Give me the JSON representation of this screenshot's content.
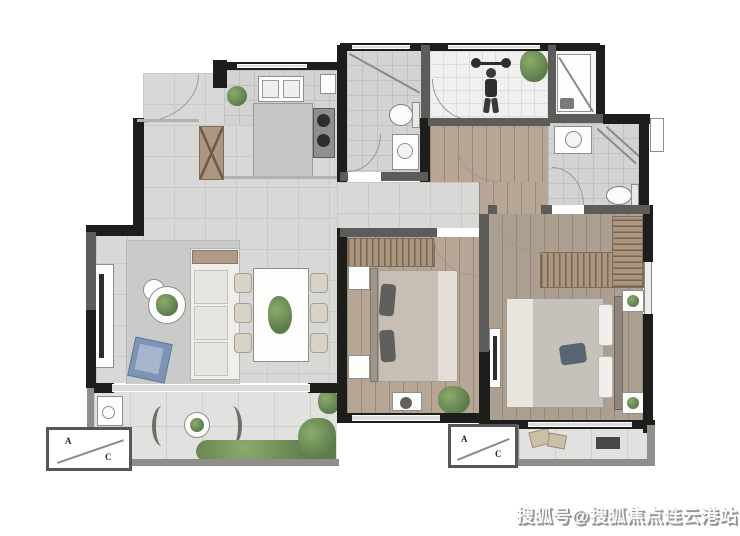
{
  "watermark": {
    "text": "搜狐号@搜狐焦点连云港站"
  },
  "ac_platforms": {
    "label_a": "A",
    "label_c": "C"
  },
  "colors": {
    "wall": "#1d1d1b",
    "wallg": "#5c5c5a",
    "wallL": "#8e8e8c",
    "tile": "#d8d8d6",
    "tile_line": "#c9c9c7",
    "bath": "#d3d4d2",
    "bath_line": "#c2c3c1",
    "gym": "#f0f0ee",
    "gym_line": "#dddddb",
    "wood": "#b7a695",
    "wood2": "#ab9f91",
    "wood_seam": "#9b8874",
    "balc": "#e1e1df",
    "balc_line": "#cfcfcd",
    "rug": "#c9cbc9",
    "tan": "#ab9680",
    "green": "#5d7c4b",
    "green_light": "#8aab6d",
    "blue": "#7e94b6",
    "blue_light": "#a7b6cf"
  }
}
